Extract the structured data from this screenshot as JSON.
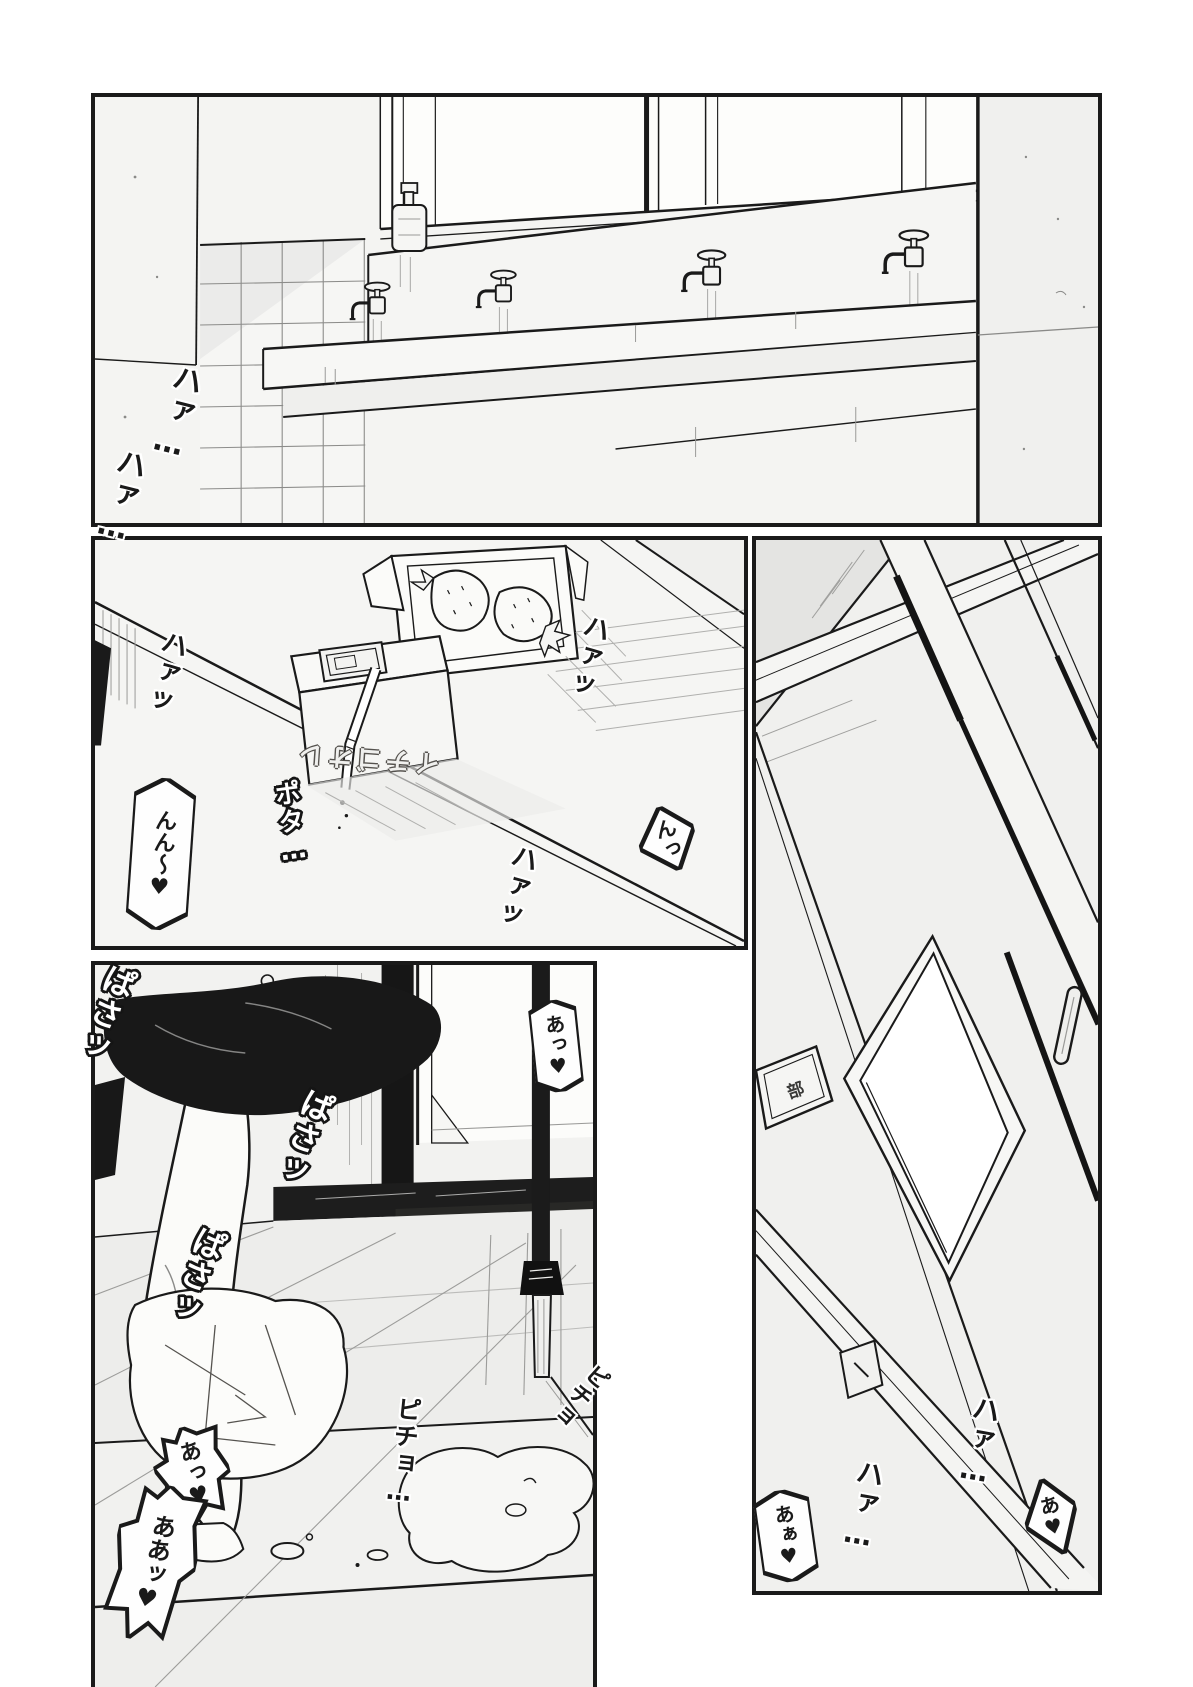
{
  "page": {
    "colors": {
      "paper": "#ffffff",
      "ink": "#1a1a1a",
      "panel_bg": "#f3f3f1",
      "shade": "#e4e4e2",
      "black_fill": "#181818"
    }
  },
  "panels": {
    "washroom": {
      "sfx": {
        "haa1": "ハァ…",
        "haa2": "ハァ…"
      }
    },
    "snack": {
      "carton_label": "イチゴオレ",
      "sfx": {
        "haa_left": "ハァッ",
        "haa_right": "ハァッ",
        "haa_bottom": "ハァッ",
        "pota": "ポタ…"
      },
      "bubbles": {
        "nn": "んん〜♥",
        "n": "んっ"
      }
    },
    "changing": {
      "sfx": {
        "pasa1": "ぱさッ",
        "pasa2": "ぱさッ",
        "pasa3": "ぱさッ",
        "picho1": "ピチョ…",
        "picho2": "ピチョ"
      },
      "bubbles": {
        "a_right": "あっ♥",
        "a_small": "あっ♥",
        "aa": "ああッ♥"
      }
    },
    "door": {
      "sign": "部",
      "sfx": {
        "haa1": "ハァ…",
        "haa2": "ハァ…"
      },
      "bubbles": {
        "aa": "あぁ♥",
        "a": "あ♥"
      }
    }
  }
}
